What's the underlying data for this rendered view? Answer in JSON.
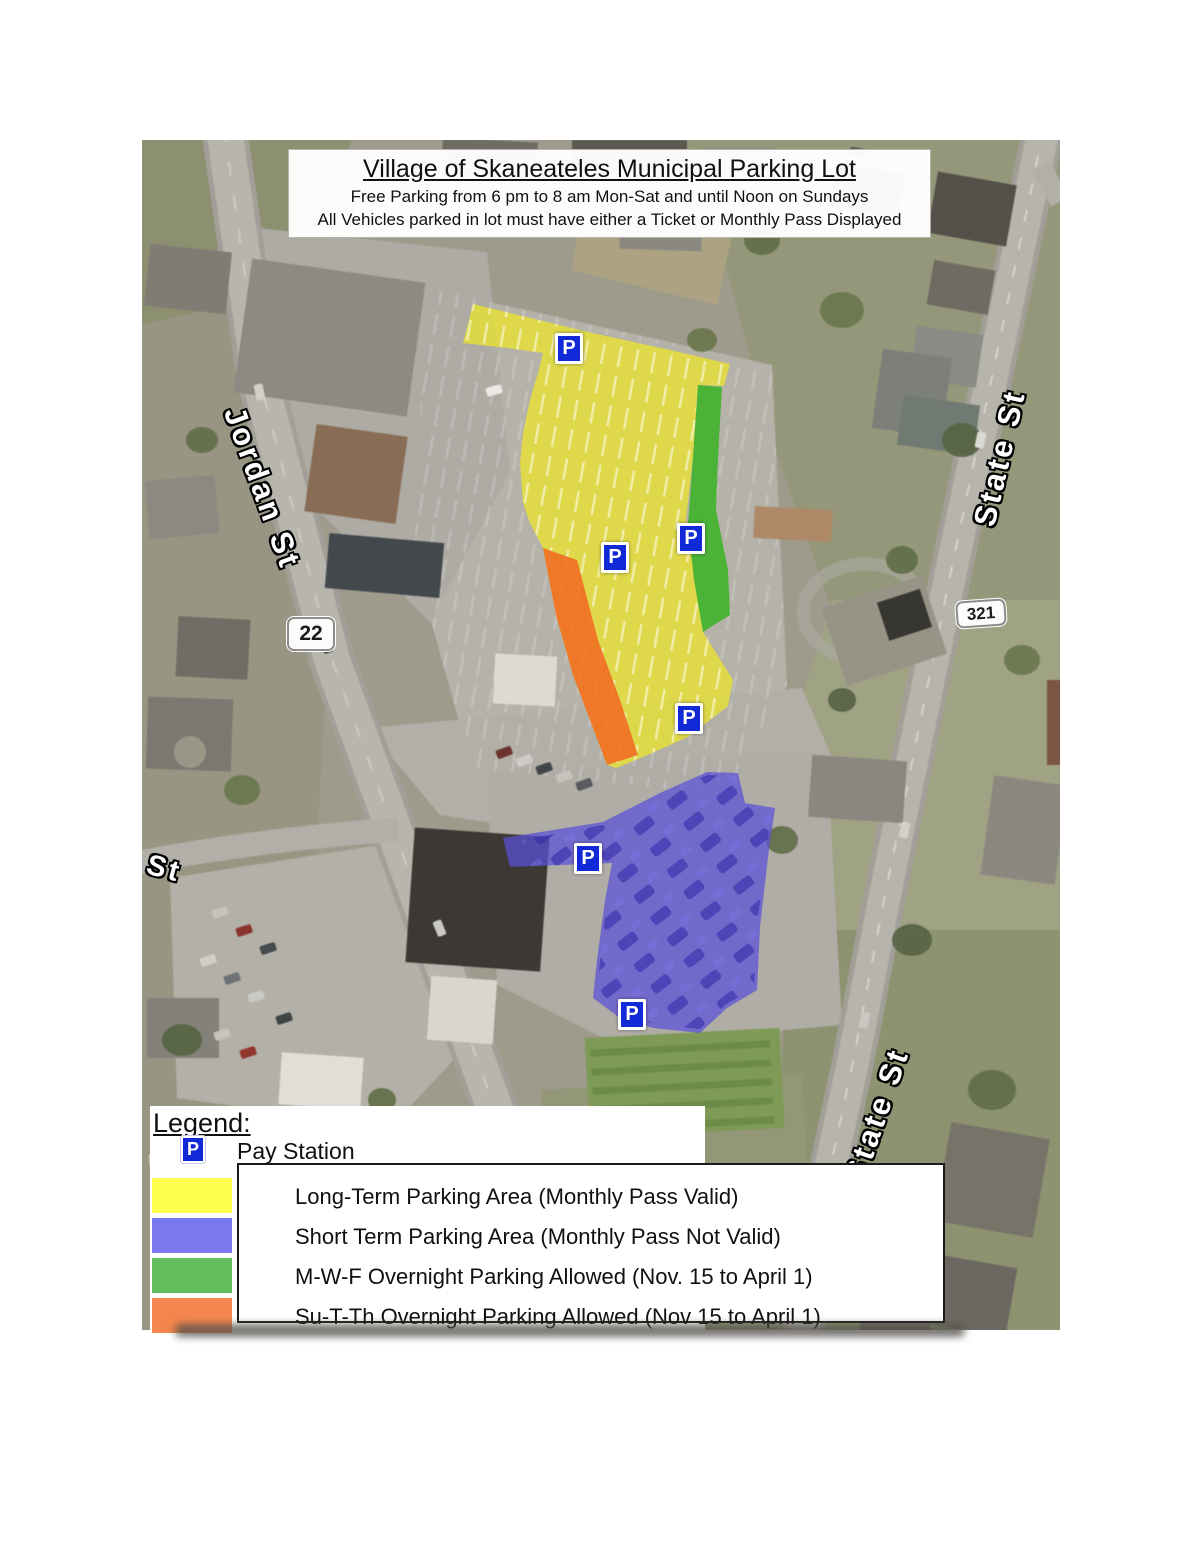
{
  "title": {
    "line1": "Village of Skaneateles Municipal Parking Lot",
    "line2": "Free Parking from 6 pm to 8 am Mon-Sat and until Noon on Sundays",
    "line3": "All Vehicles parked in lot must have either a Ticket or Monthly Pass Displayed"
  },
  "map": {
    "pay_symbol": "P",
    "street_labels": {
      "jordan": "Jordan St",
      "state_upper": "State St",
      "state_lower": "State St",
      "partial_left": "ll St"
    },
    "route_badges": {
      "jordan_route": "22",
      "state_route": "321"
    }
  },
  "overlay_colors": {
    "long_term": "#e6e135",
    "short_term": "#5a50d8",
    "mwf": "#3fb32a",
    "suth": "#f07024"
  },
  "legend": {
    "heading": "Legend:",
    "pay_symbol": "P",
    "pay_station_label": "Pay Station",
    "items": [
      {
        "label": "Long-Term Parking Area (Monthly Pass Valid)",
        "color": "#ffff4d"
      },
      {
        "label": "Short Term Parking Area (Monthly Pass Not Valid)",
        "color": "#7a78ee"
      },
      {
        "label": "M-W-F Overnight Parking Allowed (Nov. 15 to April 1)",
        "color": "#63bf5d"
      },
      {
        "label": "Su-T-Th Overnight Parking Allowed (Nov 15 to April 1)",
        "color": "#f5854e"
      }
    ]
  }
}
